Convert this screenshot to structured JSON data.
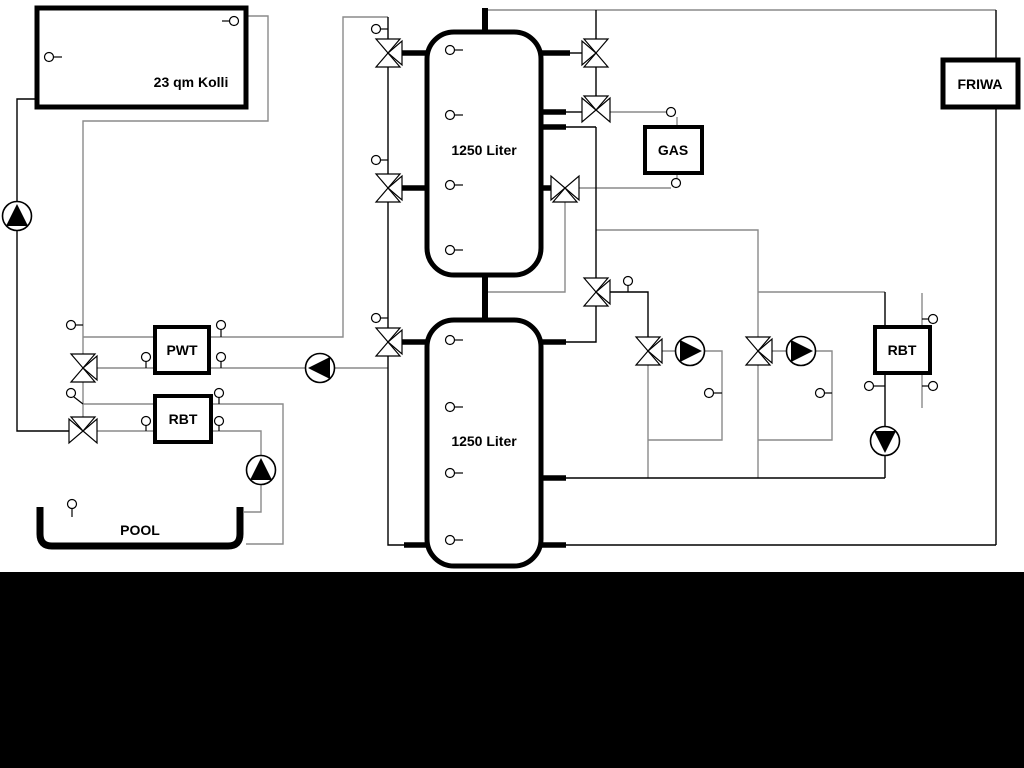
{
  "scene": {
    "type": "hydraulic-heating-schematic",
    "canvas_color": "#ffffff",
    "letterbox_color": "#000000",
    "line_color": "#000000",
    "secondary_line_color": "#8a8a8a",
    "component_fill": "#ffffff"
  },
  "labels": {
    "collector": "23 qm Kolli",
    "buffer_tank_top": "1250 Liter",
    "buffer_tank_bottom": "1250 Liter",
    "boiler": "GAS",
    "fresh_water_station": "FRIWA",
    "heat_exchanger_pwt": "PWT",
    "heat_exchanger_rbt_left": "RBT",
    "heat_exchanger_rbt_right": "RBT",
    "pool": "POOL"
  },
  "components": {
    "pumps": [
      {
        "id": "solar-pump",
        "direction": "up"
      },
      {
        "id": "pwt-charge-pump",
        "direction": "left"
      },
      {
        "id": "pool-pump",
        "direction": "up"
      },
      {
        "id": "heating-circuit-pump-1",
        "direction": "right"
      },
      {
        "id": "heating-circuit-pump-2",
        "direction": "right"
      },
      {
        "id": "rbt-right-pump",
        "direction": "down"
      }
    ],
    "three_way_valves": 11,
    "temperature_sensors": 30
  }
}
